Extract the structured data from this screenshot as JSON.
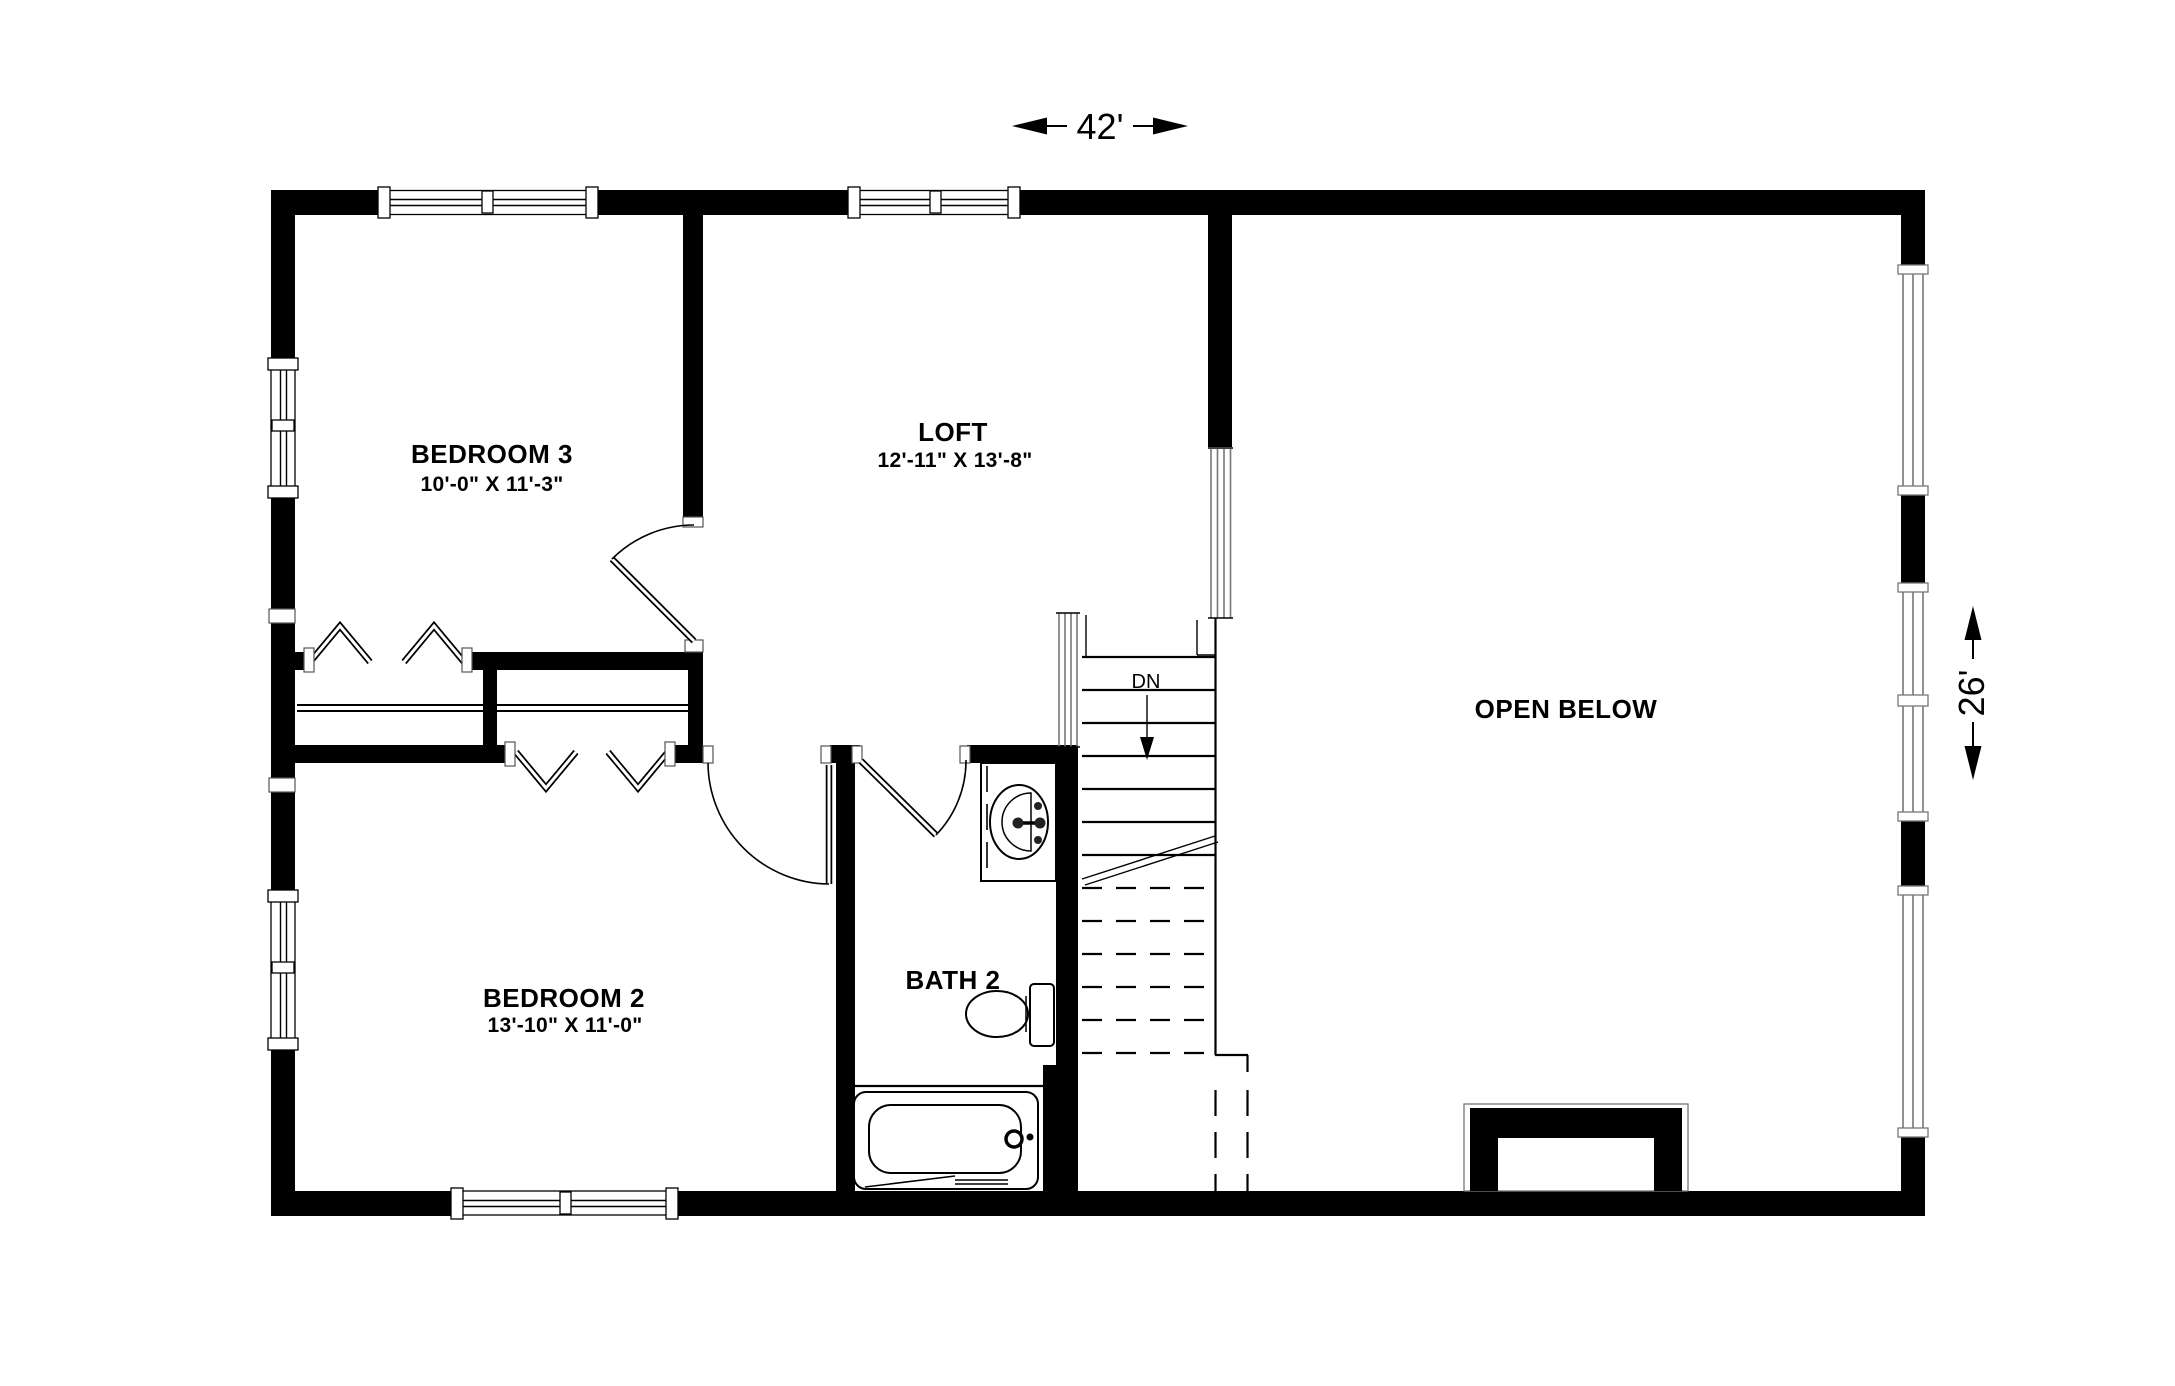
{
  "floor_plan": {
    "dimension_width": "42'",
    "dimension_height": "26'",
    "rooms": {
      "bedroom3": {
        "name": "BEDROOM 3",
        "size": "10'-0\" X 11'-3\""
      },
      "loft": {
        "name": "LOFT",
        "size": "12'-11\" X 13'-8\""
      },
      "bedroom2": {
        "name": "BEDROOM 2",
        "size": "13'-10\" X 11'-0\""
      },
      "bath2": {
        "name": "BATH 2"
      },
      "open_below": {
        "name": "OPEN BELOW"
      }
    },
    "stairs": {
      "label": "DN"
    },
    "colors": {
      "wall": "#000000",
      "window_frame": "#777777",
      "background": "#ffffff"
    }
  }
}
